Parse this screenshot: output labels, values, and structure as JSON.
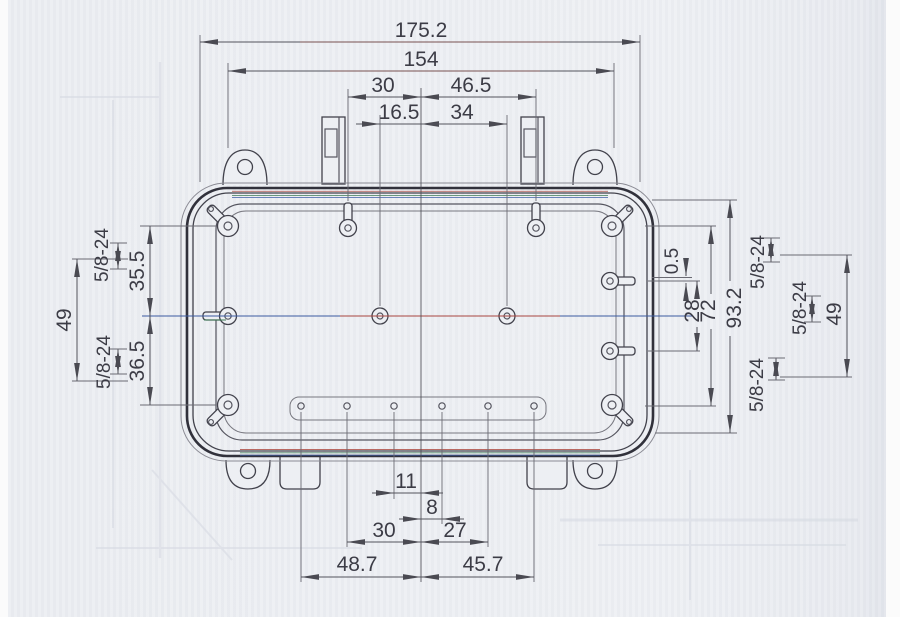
{
  "drawing": {
    "kind": "enclosure-dimension-drawing",
    "dims": {
      "overall_width": "175.2",
      "mount_span": "154",
      "top_left": "30",
      "top_right": "46.5",
      "top_hole_left": "16.5",
      "top_hole_right": "34",
      "left_upper": "35.5",
      "left_lower": "36.5",
      "left_span": "49",
      "right_span": "49",
      "right_gap": "0.5",
      "right_holes": "28",
      "right_mid": "72",
      "overall_height": "93.2",
      "bottom_inner_left": "11",
      "bottom_inner_right": "8",
      "bottom_mid_left": "30",
      "bottom_mid_right": "27",
      "bottom_outer_left": "48.7",
      "bottom_outer_right": "45.7",
      "thread": "5/8-24"
    }
  }
}
